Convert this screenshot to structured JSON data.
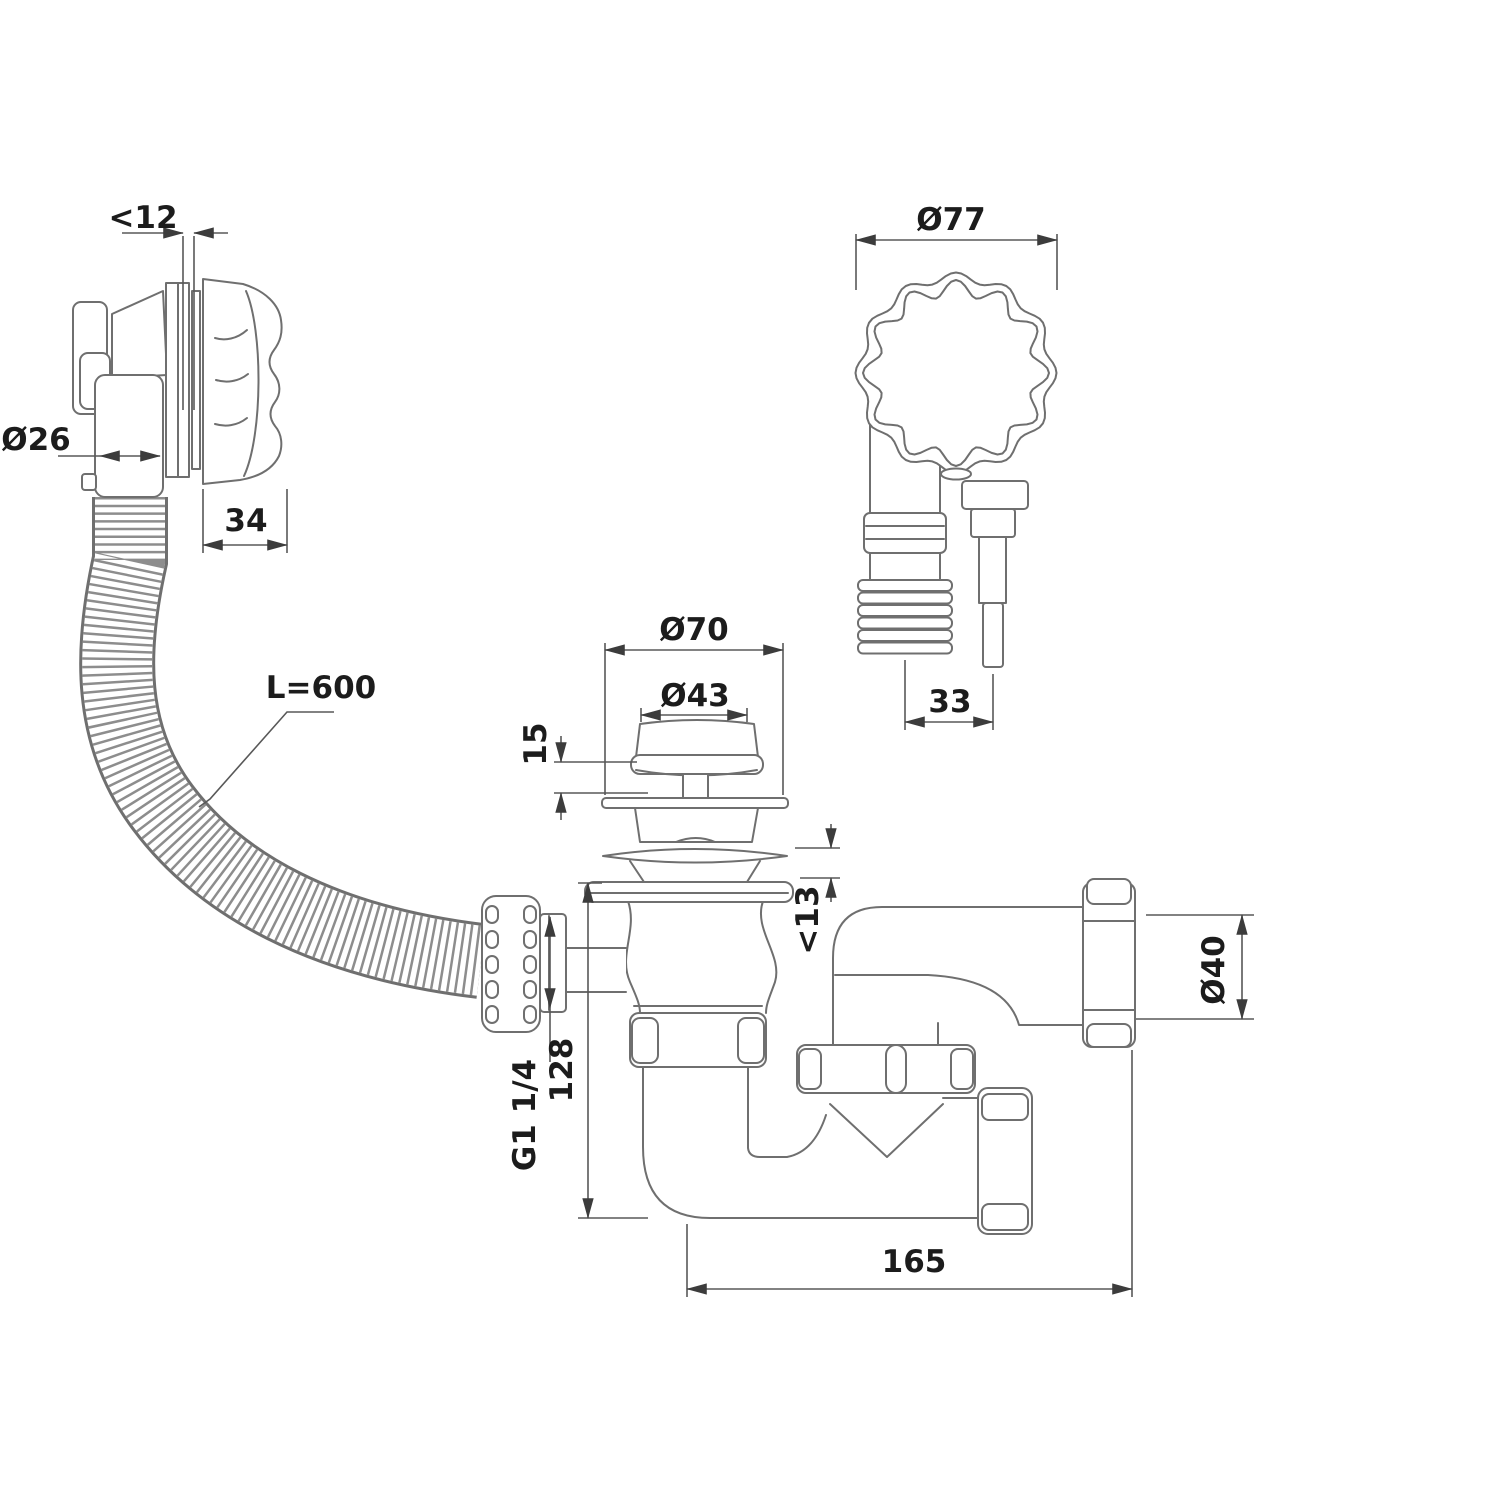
{
  "drawing": {
    "colors": {
      "background": "#ffffff",
      "line": "#6f6f6f",
      "dimension_text": "#1c1c1c"
    },
    "labels": {
      "overflow_gap": "<12",
      "overflow_pipe_d": "Ø26",
      "overflow_knob_depth": "34",
      "overflow_knob_face_d": "Ø77",
      "overflow_rod_offset": "33",
      "hose_length": "L=600",
      "drain_flange_d": "Ø70",
      "plug_cap_d": "Ø43",
      "plug_height": "15",
      "flange_clearance": "<13",
      "thread_size": "G1 1/4",
      "drain_height": "128",
      "outlet_pipe_d": "Ø40",
      "outlet_cuff_d": "Ø50",
      "trap_length": "165"
    }
  }
}
